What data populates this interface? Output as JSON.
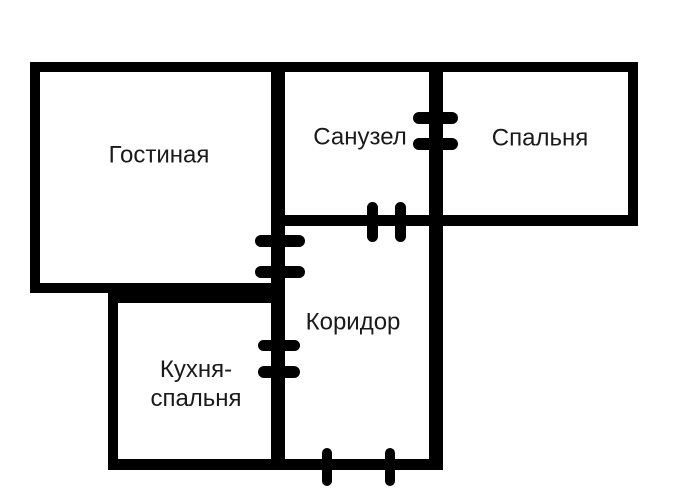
{
  "canvas": {
    "width": 700,
    "height": 503,
    "background_color": "#ffffff",
    "wall_color": "#000000",
    "text_color": "#1a1a1a"
  },
  "rooms": {
    "living_room": {
      "label": "Гостиная"
    },
    "bathroom": {
      "label": "Санузел"
    },
    "bedroom": {
      "label": "Спальня"
    },
    "corridor": {
      "label": "Коридор"
    },
    "kitchen_bedroom": {
      "label": "Кухня-\nспальня"
    }
  },
  "structure": {
    "walls": [
      {
        "name": "outer-top-wall",
        "x": 30,
        "y": 62,
        "w": 608,
        "h": 10
      },
      {
        "name": "living-room-left-wall",
        "x": 30,
        "y": 62,
        "w": 10,
        "h": 231
      },
      {
        "name": "living-room-bottom-wall",
        "x": 30,
        "y": 283,
        "w": 255,
        "h": 10
      },
      {
        "name": "kitchen-top-wall",
        "x": 108,
        "y": 293,
        "w": 177,
        "h": 10
      },
      {
        "name": "kitchen-left-wall",
        "x": 108,
        "y": 293,
        "w": 10,
        "h": 176
      },
      {
        "name": "central-vertical-wall",
        "x": 271,
        "y": 62,
        "w": 14,
        "h": 407
      },
      {
        "name": "corridor-right-wall",
        "x": 429,
        "y": 62,
        "w": 14,
        "h": 408
      },
      {
        "name": "bathroom-bedroom-bottom-wall",
        "x": 271,
        "y": 215,
        "w": 367,
        "h": 11
      },
      {
        "name": "bedroom-right-wall",
        "x": 628,
        "y": 62,
        "w": 10,
        "h": 164
      },
      {
        "name": "bottom-wall",
        "x": 108,
        "y": 459,
        "w": 334,
        "h": 11
      }
    ],
    "doors": [
      {
        "name": "door-bathroom-bedroom",
        "ticks": [
          {
            "x": 413,
            "y": 112,
            "w": 45,
            "h": 12
          },
          {
            "x": 413,
            "y": 138,
            "w": 45,
            "h": 12
          }
        ]
      },
      {
        "name": "door-bathroom-corridor",
        "ticks": [
          {
            "x": 367,
            "y": 202,
            "w": 11,
            "h": 40
          },
          {
            "x": 395,
            "y": 202,
            "w": 11,
            "h": 40
          }
        ]
      },
      {
        "name": "door-living-room-corridor",
        "ticks": [
          {
            "x": 255,
            "y": 235,
            "w": 50,
            "h": 12
          },
          {
            "x": 255,
            "y": 266,
            "w": 50,
            "h": 12
          }
        ]
      },
      {
        "name": "door-kitchen-corridor",
        "ticks": [
          {
            "x": 258,
            "y": 340,
            "w": 42,
            "h": 11
          },
          {
            "x": 258,
            "y": 366,
            "w": 42,
            "h": 12
          }
        ]
      },
      {
        "name": "door-corridor-entrance",
        "ticks": [
          {
            "x": 322,
            "y": 448,
            "w": 10,
            "h": 38
          },
          {
            "x": 385,
            "y": 448,
            "w": 10,
            "h": 38
          }
        ]
      }
    ],
    "labels": [
      {
        "room": "living_room",
        "cx": 159,
        "cy": 155
      },
      {
        "room": "bathroom",
        "cx": 360,
        "cy": 137
      },
      {
        "room": "bedroom",
        "cx": 540,
        "cy": 138
      },
      {
        "room": "corridor",
        "cx": 353,
        "cy": 322
      },
      {
        "room": "kitchen_bedroom",
        "cx": 196,
        "cy": 384
      }
    ]
  }
}
